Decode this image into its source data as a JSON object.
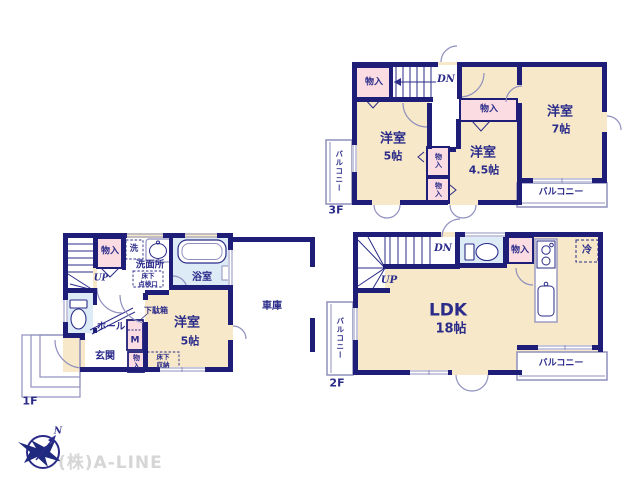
{
  "company": {
    "name": "(株)A-LINE"
  },
  "compass": {
    "north": "N"
  },
  "colors": {
    "wall": "#1e1e78",
    "text": "#2b2b8a",
    "room_fill": "#f6e8c8",
    "closet_fill": "#fadce2",
    "wet_area_fill": "#dcebf6",
    "light_line": "#8f8fbe",
    "logo_text": "#d6d6d6"
  },
  "floor3": {
    "label": "3F",
    "room5": {
      "name": "洋室",
      "size": "5帖"
    },
    "room45": {
      "name": "洋室",
      "size": "4.5帖"
    },
    "room7": {
      "name": "洋室",
      "size": "7帖"
    },
    "closet_top": "物入",
    "closet_mid": "物入",
    "closet_v1": "物入",
    "closet_v2": "物入",
    "balcony_left": "バルコニー",
    "balcony_bottom": "バルコニー",
    "stairs_down": "DN"
  },
  "floor2": {
    "label": "2F",
    "ldk": {
      "name": "LDK",
      "size": "18帖"
    },
    "closet": "物入",
    "fridge": "冷",
    "balcony_left": "バルコニー",
    "balcony_bottom": "バルコニー",
    "stairs_down": "DN",
    "stairs_up": "UP"
  },
  "floor1": {
    "label": "1F",
    "room5": {
      "name": "洋室",
      "size": "5帖"
    },
    "entrance": "玄関",
    "hall": "ホール",
    "washroom": "洗面所",
    "bath": "浴室",
    "laundry": "洗",
    "garage": "車庫",
    "closet_top": "物入",
    "closet_bottom": "物入",
    "shoe_cabinet": "下駄箱",
    "meter": "M",
    "underfloor_hatch": {
      "line1": "床下",
      "line2": "点検口"
    },
    "underfloor_storage": {
      "line1": "床下",
      "line2": "収納"
    },
    "stairs_up": "UP"
  }
}
